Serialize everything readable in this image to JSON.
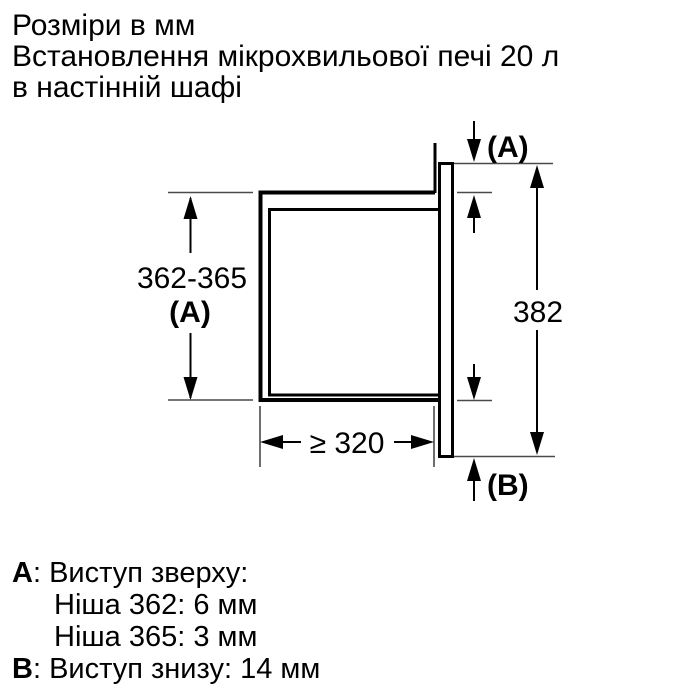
{
  "header": {
    "line1": "Розміри в мм",
    "line2": "Встановлення мікрохвильової печі 20 л",
    "line3": "в настінній шафі"
  },
  "diagram": {
    "niche_height_value": "362-365",
    "niche_height_label": "(A)",
    "top_gap_label": "(A)",
    "front_height_value": "382",
    "niche_depth_value": "≥ 320",
    "bottom_gap_label": "(B)"
  },
  "notes": {
    "a_key": "A",
    "a_rest": ": Виступ зверху:",
    "a_detail1": "Ніша 362: 6 мм",
    "a_detail2": "Ніша 365: 3 мм",
    "b_key": "B",
    "b_rest": ": Виступ знизу: 14 мм"
  },
  "colors": {
    "background": "#ffffff",
    "line": "#000000",
    "extension_line": "#4a4a4a",
    "text": "#000000"
  }
}
